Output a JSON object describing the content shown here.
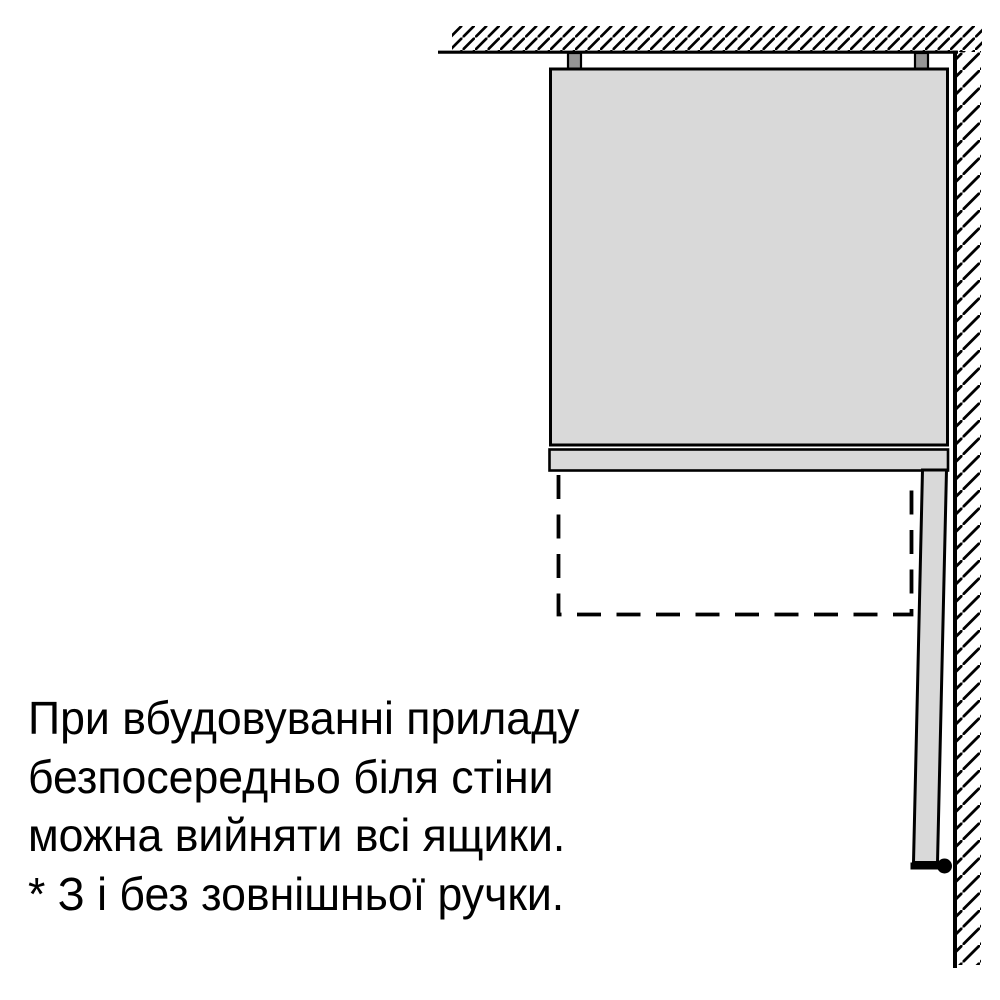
{
  "caption": {
    "lines": [
      "При вбудовуванні приладу",
      "безпосередньо біля стіни",
      "можна вийняти всі ящики.",
      "* З і без зовнішньої ручки."
    ]
  },
  "colors": {
    "background": "#ffffff",
    "appliance_fill": "#d9d9d9",
    "bracket_fill": "#969696",
    "line": "#000000",
    "text": "#000000"
  }
}
